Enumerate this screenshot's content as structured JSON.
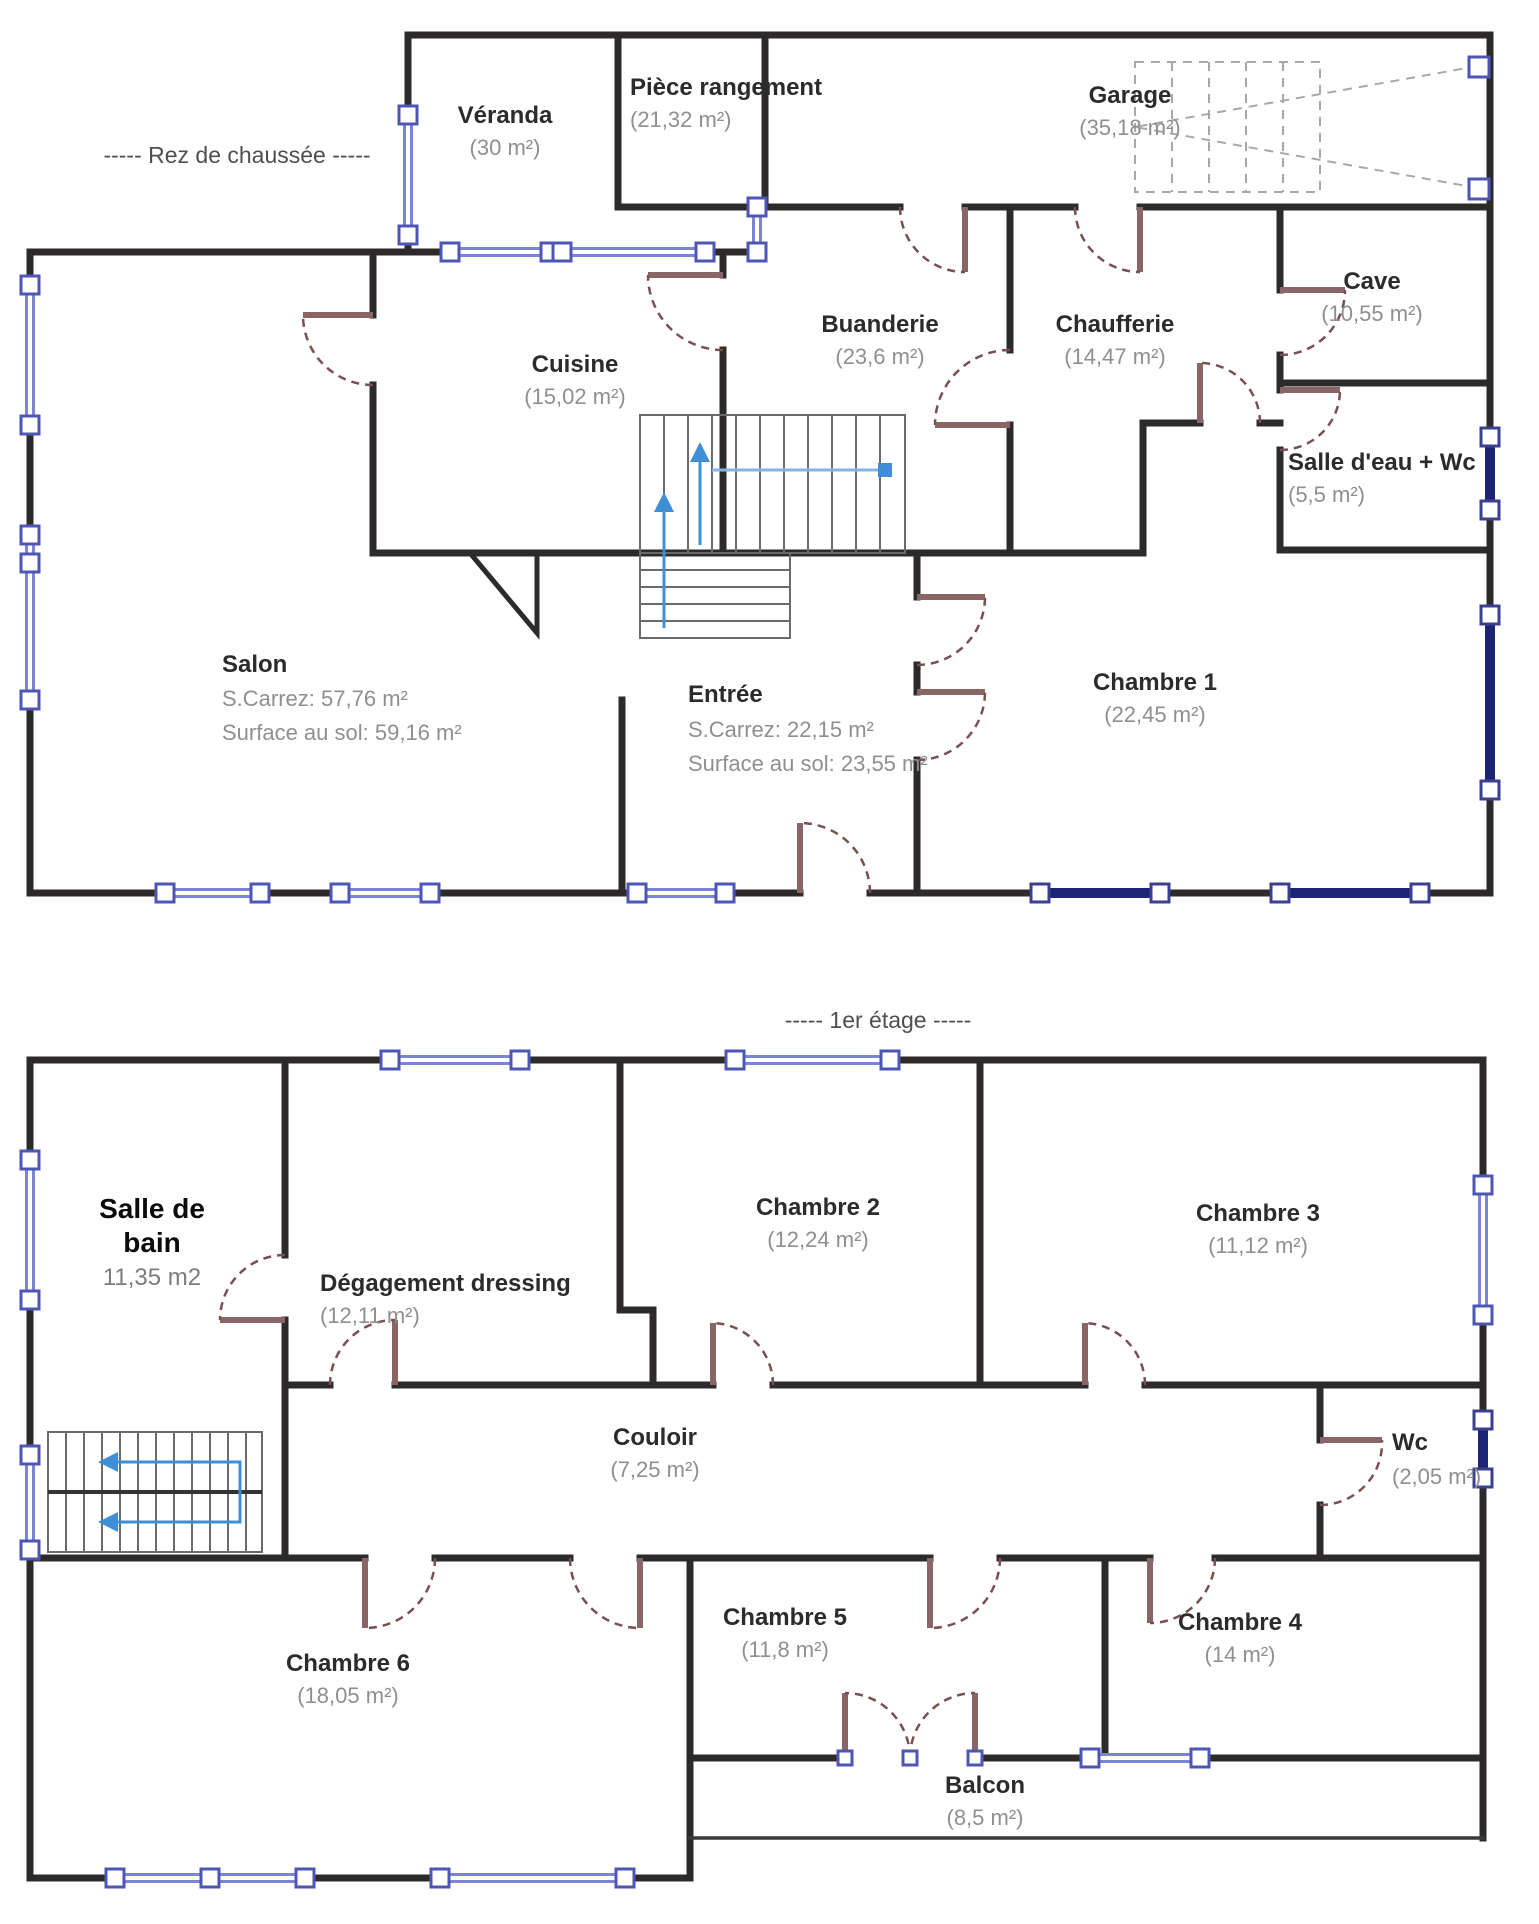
{
  "ground_floor": {
    "title": "-----  Rez de chaussée  -----",
    "rooms": {
      "veranda": {
        "name": "Véranda",
        "area": "(30 m²)"
      },
      "piece_rangement": {
        "name": "Pièce rangement",
        "area": "(21,32 m²)"
      },
      "garage": {
        "name": "Garage",
        "area": "(35,18 m²)"
      },
      "cuisine": {
        "name": "Cuisine",
        "area": "(15,02 m²)"
      },
      "buanderie": {
        "name": "Buanderie",
        "area": "(23,6 m²)"
      },
      "chaufferie": {
        "name": "Chaufferie",
        "area": "(14,47 m²)"
      },
      "cave": {
        "name": "Cave",
        "area": "(10,55 m²)"
      },
      "salle_eau_wc": {
        "name": "Salle d'eau + Wc",
        "area": "(5,5 m²)"
      },
      "salon": {
        "name": "Salon",
        "carrez": "S.Carrez: 57,76 m²",
        "sol": "Surface au sol: 59,16 m²"
      },
      "entree": {
        "name": "Entrée",
        "carrez": "S.Carrez: 22,15 m²",
        "sol": "Surface au sol: 23,55 m²"
      },
      "chambre1": {
        "name": "Chambre 1",
        "area": "(22,45 m²)"
      }
    }
  },
  "first_floor": {
    "title": "-----  1er étage  -----",
    "rooms": {
      "salle_de_bain": {
        "name_line1": "Salle de",
        "name_line2": "bain",
        "area": "11,35 m2"
      },
      "degagement": {
        "name": "Dégagement dressing",
        "area": "(12,11 m²)"
      },
      "chambre2": {
        "name": "Chambre 2",
        "area": "(12,24 m²)"
      },
      "chambre3": {
        "name": "Chambre 3",
        "area": "(11,12 m²)"
      },
      "couloir": {
        "name": "Couloir",
        "area": "(7,25 m²)"
      },
      "wc": {
        "name": "Wc",
        "area": "(2,05 m²)"
      },
      "chambre6": {
        "name": "Chambre 6",
        "area": "(18,05 m²)"
      },
      "chambre5": {
        "name": "Chambre 5",
        "area": "(11,8 m²)"
      },
      "chambre4": {
        "name": "Chambre 4",
        "area": "(14 m²)"
      },
      "balcon": {
        "name": "Balcon",
        "area": "(8,5 m²)"
      }
    }
  },
  "colors": {
    "wall": "#2d2a2a",
    "window_blue": "#7b84d6",
    "window_navy": "#1d2375",
    "door_brown": "#8a6565",
    "stair_arrow_blue": "#3f8fd6",
    "room_name_text": "#2b2b2b",
    "area_text": "#8f8f8f"
  }
}
